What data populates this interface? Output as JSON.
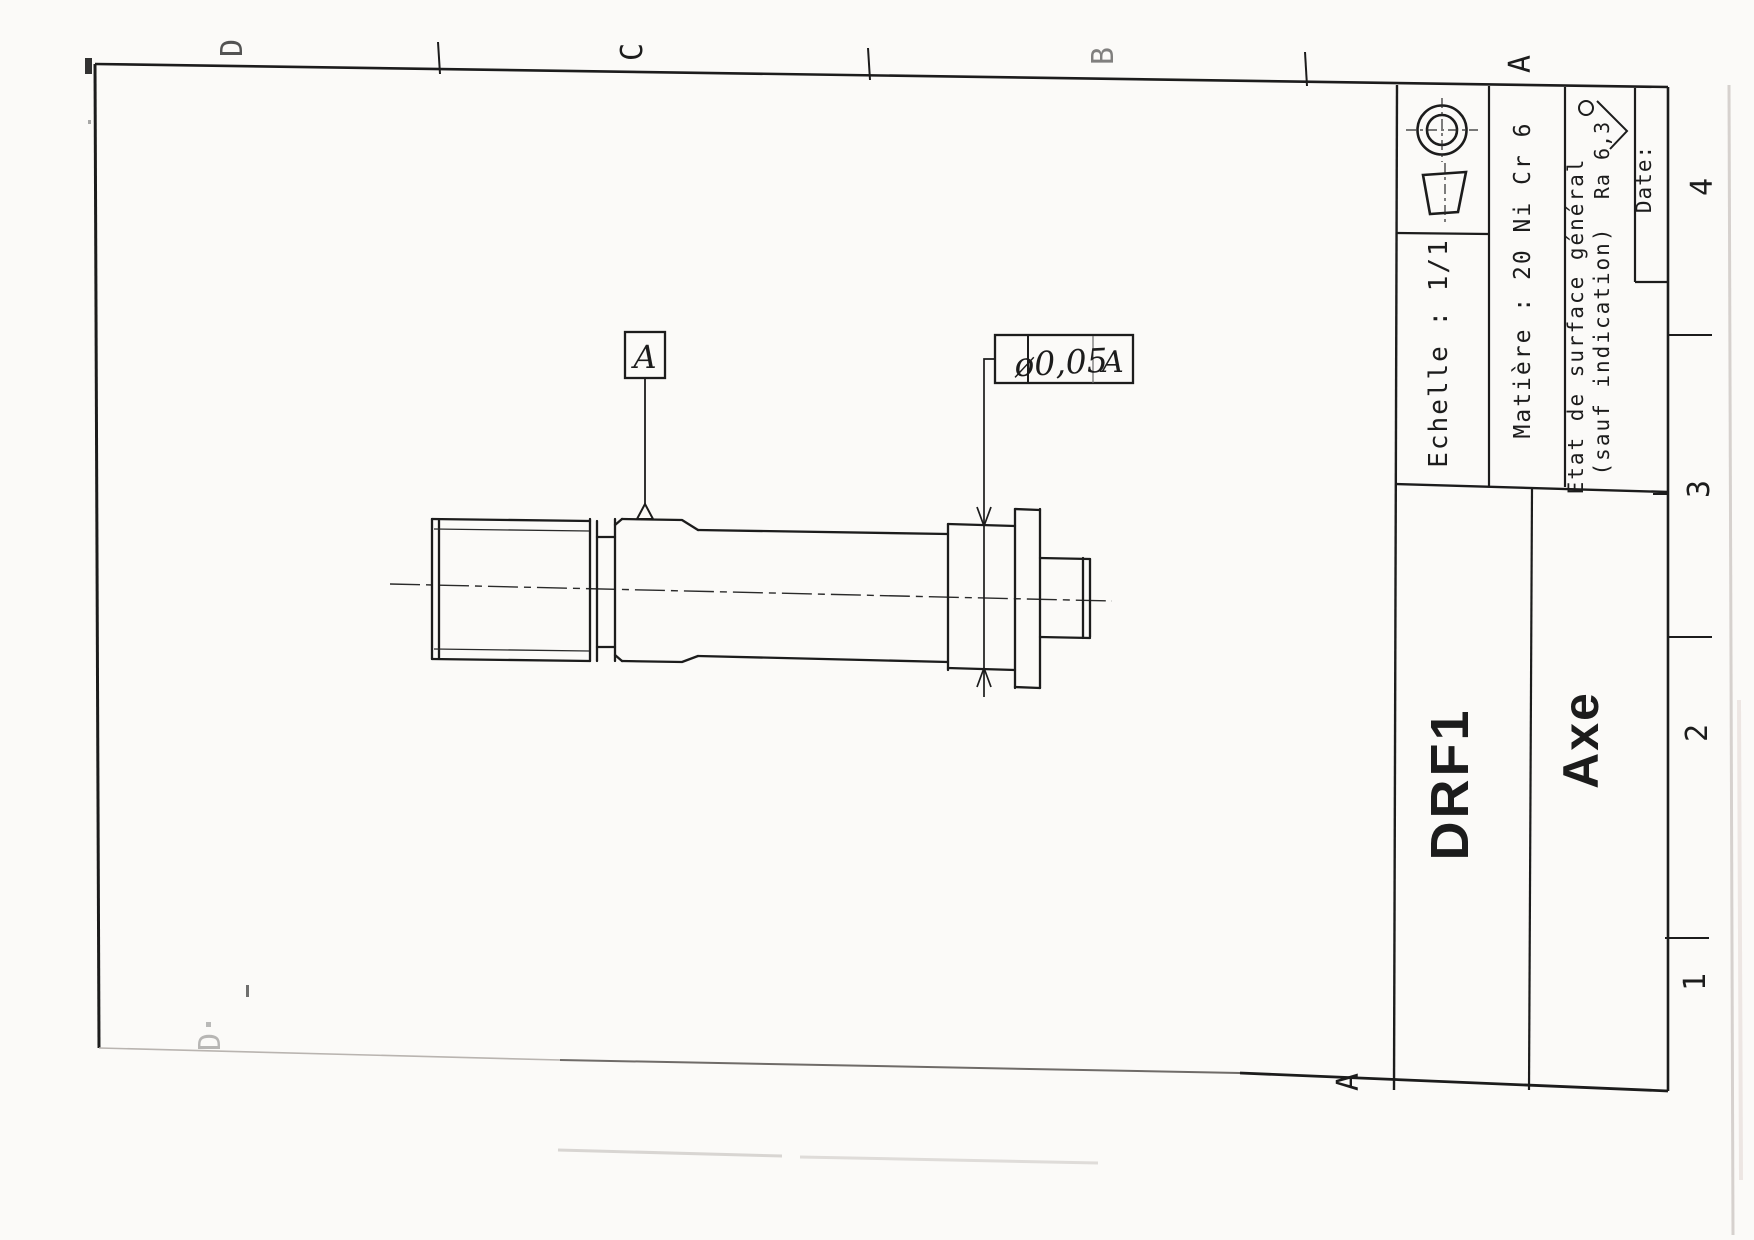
{
  "document_type": "scanned engineering drawing (rotated 90°)",
  "zones": {
    "top": [
      "D",
      "C",
      "B",
      "A"
    ],
    "right": [
      "4",
      "3",
      "2",
      "1"
    ],
    "bottom": [
      "D",
      "A"
    ]
  },
  "title_block": {
    "scale_label": "Echelle : 1/1",
    "material_label": "Matière : 20 Ni Cr 6",
    "surface_line1": "Etat de surface général",
    "surface_line2": "(sauf indication)",
    "roughness_value": "Ra 6,3",
    "date_label": "Date:",
    "drawing_code": "DRF1",
    "part_name": "Axe",
    "projection_symbol": "first-angle-projection-icon",
    "roughness_symbol": "surface-finish-check-icon"
  },
  "annotations": {
    "datum_label": "A",
    "tolerance_value": "ø0,05",
    "tolerance_datum": "A"
  },
  "colors": {
    "ink": "#1c1c1c",
    "paper": "#fbfaf8",
    "scan_artifact": "#c9c3bf"
  }
}
